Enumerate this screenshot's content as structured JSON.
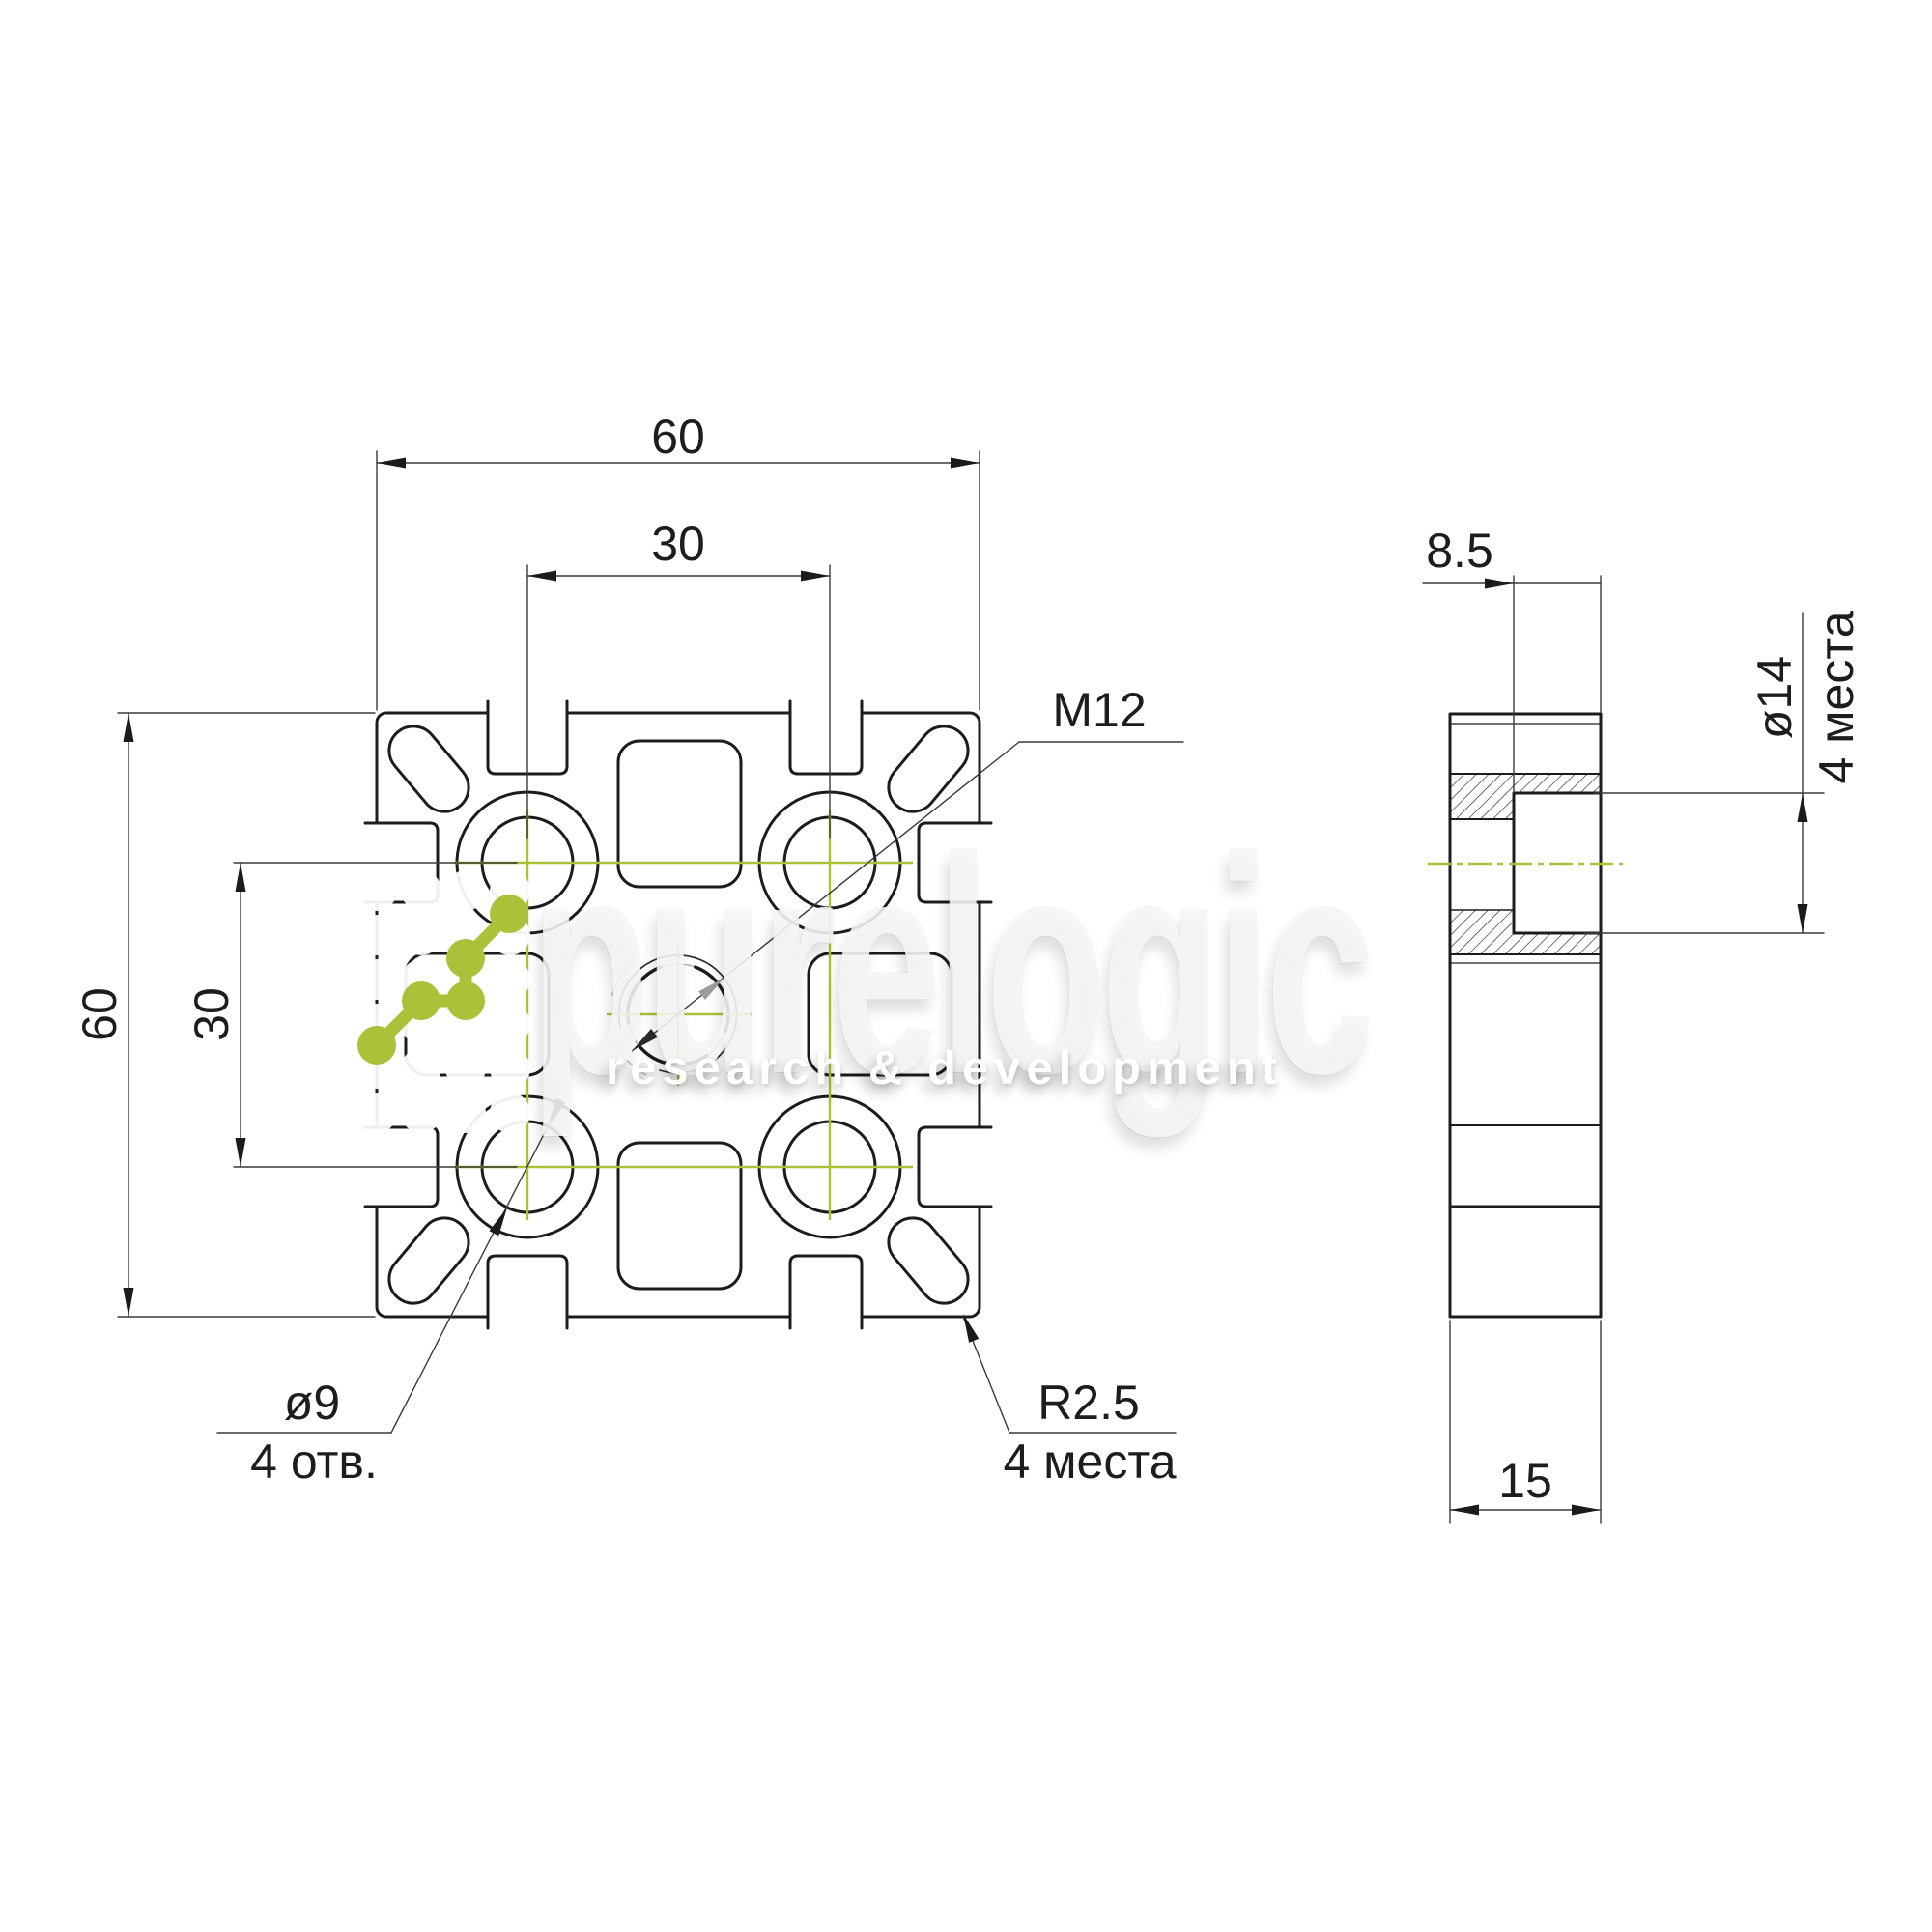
{
  "front_view": {
    "dim_width_top": "60",
    "dim_hole_spacing_top": "30",
    "dim_height_left": "60",
    "dim_hole_spacing_left": "30",
    "thread_label": "M12",
    "hole_dia_label": "ø9",
    "hole_qty_label": "4 отв.",
    "corner_radius_label": "R2.5",
    "corner_radius_qty_label": "4 места"
  },
  "side_view": {
    "counterbore_depth": "8.5",
    "counterbore_dia_label": "ø14",
    "counterbore_qty_label": "4 места",
    "thickness": "15"
  },
  "watermark": {
    "brand": "purelogic",
    "subtitle": "research & development"
  },
  "colors": {
    "accent_green": "#a9c23a",
    "line_dark": "#1c1c1c"
  }
}
